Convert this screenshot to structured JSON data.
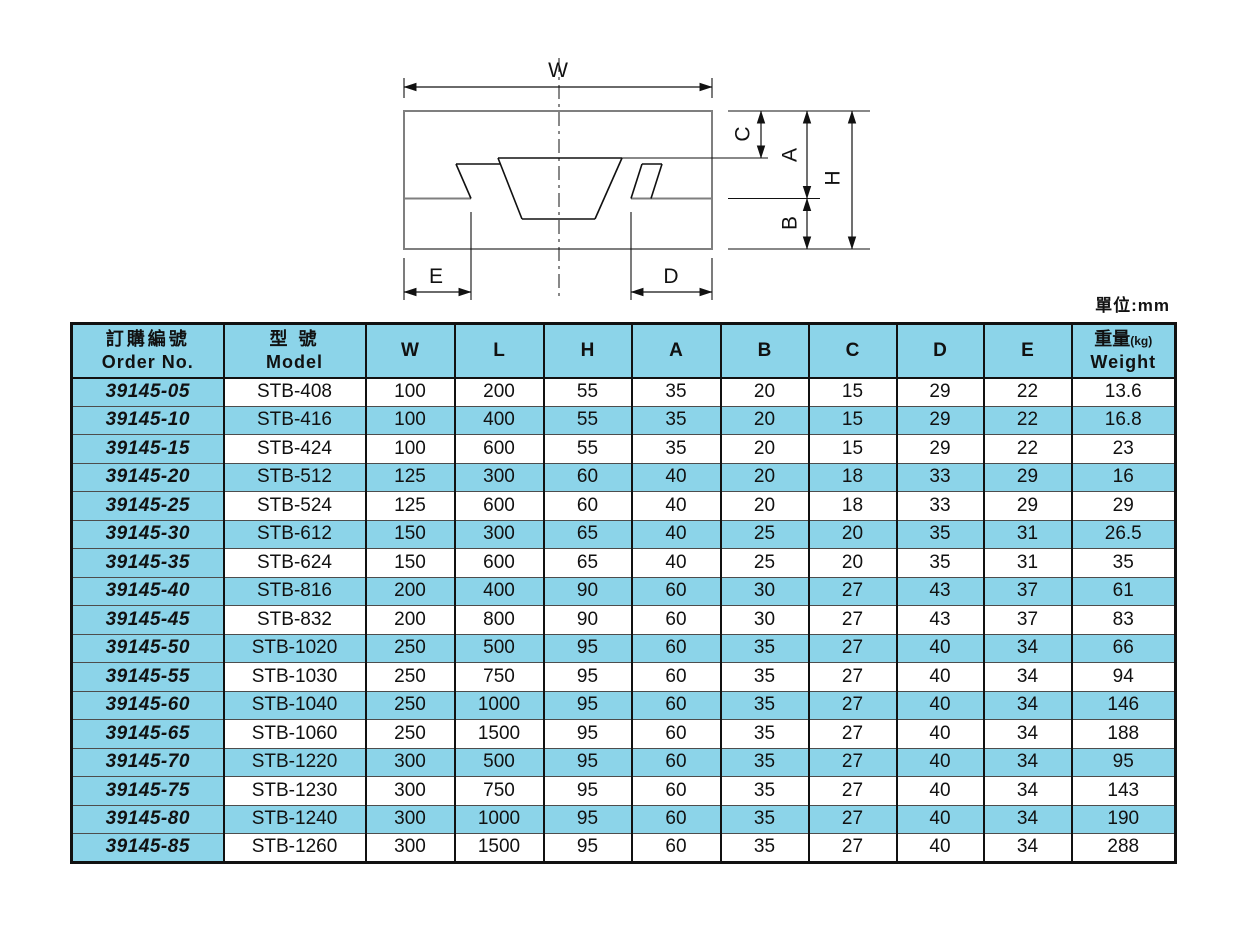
{
  "page": {
    "unit_note": "單位:mm"
  },
  "colors": {
    "header_blue": "#8cd4e9",
    "row_blue": "#8cd4e9",
    "border_black": "#111111",
    "diagram_gray": "#7f7f7f"
  },
  "diagram": {
    "labels": {
      "w": "W",
      "c": "C",
      "a": "A",
      "h": "H",
      "b": "B",
      "e": "E",
      "d": "D"
    }
  },
  "table": {
    "headers": {
      "order_zh": "訂購編號",
      "order_en": "Order No.",
      "model_zh": "型 號",
      "model_en": "Model",
      "dims": [
        "W",
        "L",
        "H",
        "A",
        "B",
        "C",
        "D",
        "E"
      ],
      "weight_zh": "重量",
      "weight_unit": "(kg)",
      "weight_en": "Weight"
    },
    "rows": [
      {
        "order": "39145-05",
        "model": "STB-408",
        "values": [
          100,
          200,
          55,
          35,
          20,
          15,
          29,
          22,
          13.6
        ]
      },
      {
        "order": "39145-10",
        "model": "STB-416",
        "values": [
          100,
          400,
          55,
          35,
          20,
          15,
          29,
          22,
          16.8
        ]
      },
      {
        "order": "39145-15",
        "model": "STB-424",
        "values": [
          100,
          600,
          55,
          35,
          20,
          15,
          29,
          22,
          23
        ]
      },
      {
        "order": "39145-20",
        "model": "STB-512",
        "values": [
          125,
          300,
          60,
          40,
          20,
          18,
          33,
          29,
          16
        ]
      },
      {
        "order": "39145-25",
        "model": "STB-524",
        "values": [
          125,
          600,
          60,
          40,
          20,
          18,
          33,
          29,
          29
        ]
      },
      {
        "order": "39145-30",
        "model": "STB-612",
        "values": [
          150,
          300,
          65,
          40,
          25,
          20,
          35,
          31,
          26.5
        ]
      },
      {
        "order": "39145-35",
        "model": "STB-624",
        "values": [
          150,
          600,
          65,
          40,
          25,
          20,
          35,
          31,
          35
        ]
      },
      {
        "order": "39145-40",
        "model": "STB-816",
        "values": [
          200,
          400,
          90,
          60,
          30,
          27,
          43,
          37,
          61
        ]
      },
      {
        "order": "39145-45",
        "model": "STB-832",
        "values": [
          200,
          800,
          90,
          60,
          30,
          27,
          43,
          37,
          83
        ]
      },
      {
        "order": "39145-50",
        "model": "STB-1020",
        "values": [
          250,
          500,
          95,
          60,
          35,
          27,
          40,
          34,
          66
        ]
      },
      {
        "order": "39145-55",
        "model": "STB-1030",
        "values": [
          250,
          750,
          95,
          60,
          35,
          27,
          40,
          34,
          94
        ]
      },
      {
        "order": "39145-60",
        "model": "STB-1040",
        "values": [
          250,
          1000,
          95,
          60,
          35,
          27,
          40,
          34,
          146
        ]
      },
      {
        "order": "39145-65",
        "model": "STB-1060",
        "values": [
          250,
          1500,
          95,
          60,
          35,
          27,
          40,
          34,
          188
        ]
      },
      {
        "order": "39145-70",
        "model": "STB-1220",
        "values": [
          300,
          500,
          95,
          60,
          35,
          27,
          40,
          34,
          95
        ]
      },
      {
        "order": "39145-75",
        "model": "STB-1230",
        "values": [
          300,
          750,
          95,
          60,
          35,
          27,
          40,
          34,
          143
        ]
      },
      {
        "order": "39145-80",
        "model": "STB-1240",
        "values": [
          300,
          1000,
          95,
          60,
          35,
          27,
          40,
          34,
          190
        ]
      },
      {
        "order": "39145-85",
        "model": "STB-1260",
        "values": [
          300,
          1500,
          95,
          60,
          35,
          27,
          40,
          34,
          288
        ]
      }
    ]
  }
}
